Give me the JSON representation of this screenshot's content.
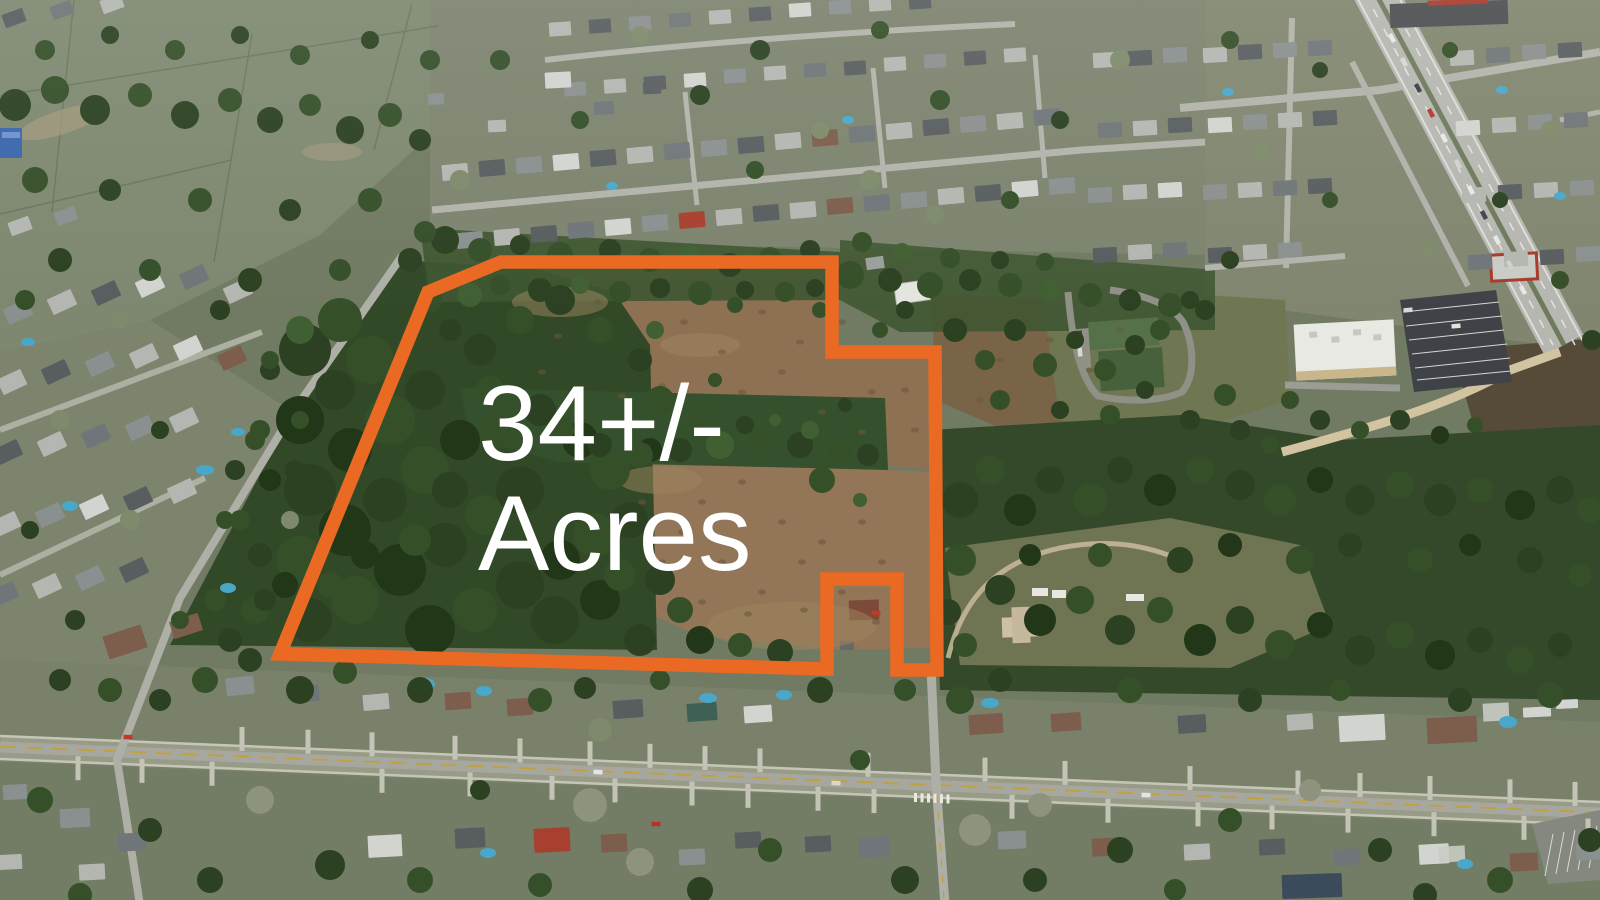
{
  "annotation": {
    "acreage_label": {
      "line1": "34+/-",
      "line2": "Acres"
    },
    "text_color": "#ffffff",
    "boundary_color": "#ea6a24",
    "boundary_stroke_width": "13.5",
    "boundary_points": "501,262 832,262 832,352 935,352 937,670 897,670 897,579 827,579 827,669 280,654 428,292"
  }
}
